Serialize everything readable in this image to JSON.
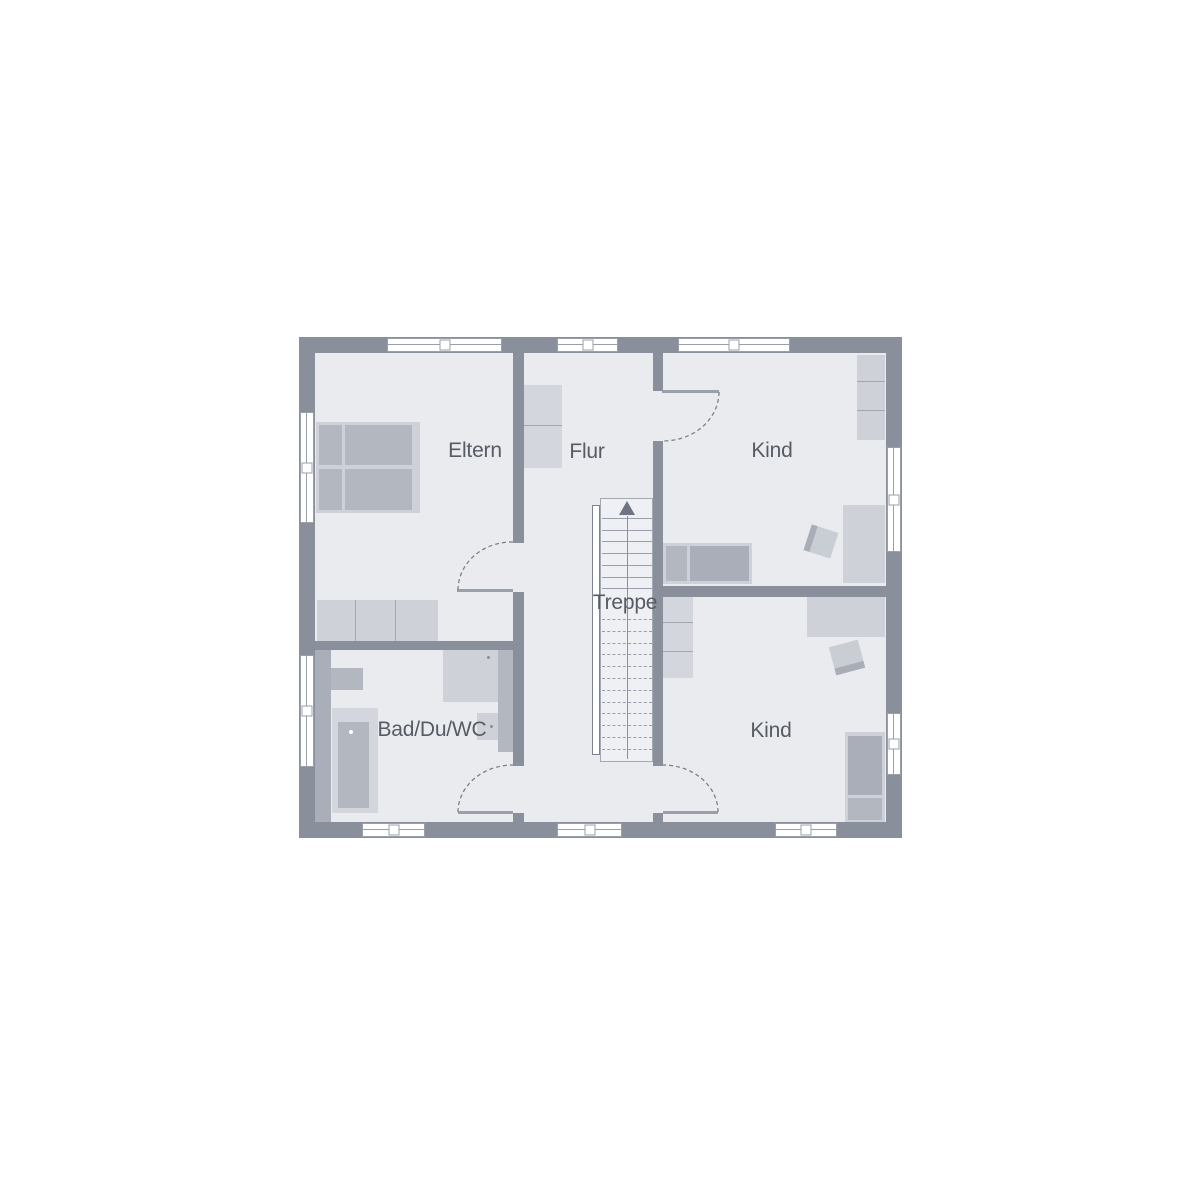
{
  "plan": {
    "type": "floor-plan",
    "language": "de",
    "rooms": [
      {
        "id": "eltern",
        "label": "Eltern"
      },
      {
        "id": "flur",
        "label": "Flur"
      },
      {
        "id": "kind_top",
        "label": "Kind"
      },
      {
        "id": "treppe",
        "label": "Treppe"
      },
      {
        "id": "bad_du_wc",
        "label": "Bad/Du/WC"
      },
      {
        "id": "kind_bottom",
        "label": "Kind"
      }
    ],
    "stairs": {
      "direction": "up",
      "solidSteps": 7,
      "dashedSteps": 12
    },
    "counts": {
      "windows": 10,
      "doors": 4,
      "rooms": 5
    },
    "colors": {
      "wall": "#8a8f9c",
      "floor": "#e9ebef",
      "stairFloor": "#eef0f3",
      "line": "#9aa0aa",
      "text": "#565b64",
      "furnitureLight": "#ced2d8",
      "furnitureLighter": "#d3d6dc",
      "furnitureMedium": "#b2b7c0",
      "furnitureDark": "#a9aeb8",
      "doorLeaf": "#99a0aa",
      "arc": "#7b818d",
      "window": "#ffffff"
    }
  }
}
